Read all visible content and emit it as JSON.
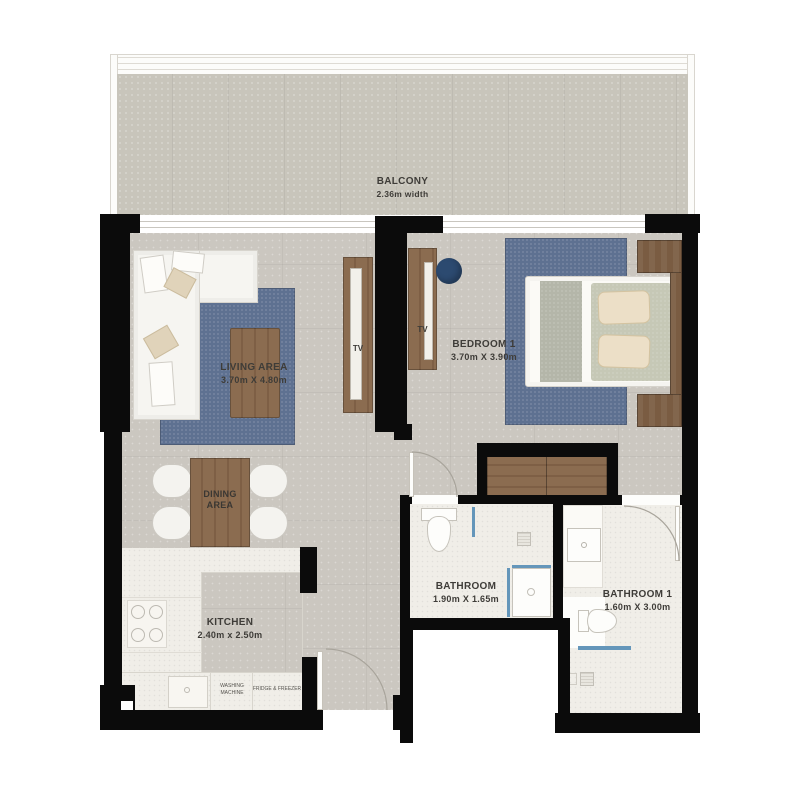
{
  "colors": {
    "wall": "#0b0b0b",
    "floor": "#cbc7c0",
    "floor_balcony": "#c8c5bb",
    "tile": "#f0eee8",
    "rug_blue": "#5e7191",
    "wood": "#8b6c50",
    "wood_dark": "#7e5f45",
    "wood_deep": "#7a5c42",
    "accent_chair": "#2c4a70",
    "glass_blue": "#6496ba",
    "sofa_white": "#f6f5f1",
    "fixture_border": "#c6c3bb",
    "arc": "#a8a49b",
    "text": "#3e3c38"
  },
  "labels": {
    "balcony": {
      "name": "BALCONY",
      "dim": "2.36m width"
    },
    "living": {
      "name": "LIVING AREA",
      "dim": "3.70m X 4.80m"
    },
    "bedroom": {
      "name": "BEDROOM 1",
      "dim": "3.70m X 3.90m"
    },
    "dining": {
      "name": "DINING\nAREA"
    },
    "kitchen": {
      "name": "KITCHEN",
      "dim": "2.40m x 2.50m"
    },
    "bathroom": {
      "name": "BATHROOM",
      "dim": "1.90m X 1.65m"
    },
    "bathroom1": {
      "name": "BATHROOM 1",
      "dim": "1.60m X 3.00m"
    },
    "tv_living": "TV",
    "tv_bedroom": "TV",
    "washing_machine": "WASHING\nMACHINE",
    "fridge": "FRIDGE & FREEZER"
  }
}
